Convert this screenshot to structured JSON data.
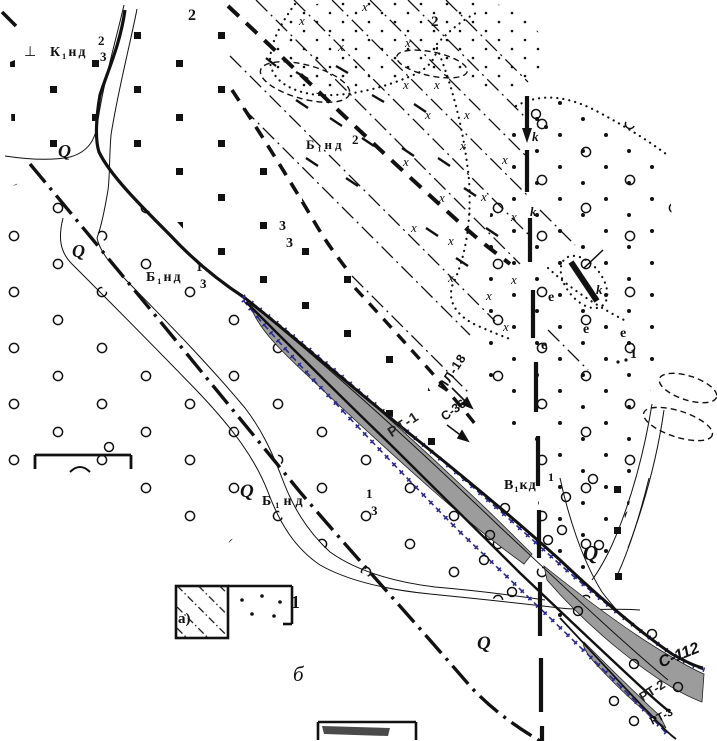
{
  "figure": {
    "type": "geological-sketch-map",
    "labels": {
      "q": "Q",
      "x": "x",
      "k": "k",
      "e": "e",
      "perp": "⊥",
      "unit_knd": "К₁нд",
      "unit_bnd": "Б₁нд",
      "unit_vkd": "В₁кд",
      "n1": "1",
      "n2": "2",
      "n3": "3",
      "ore_zone_1": "РТ-1",
      "ore_zone_2": "РТ-2",
      "ore_zone_3": "РТ-3",
      "borehole_c36": "С-36",
      "borehole_c112": "С-112",
      "profile_pl18": "ПЛ-18",
      "legend_a": "а)",
      "legend_b": "б",
      "legend_1": "1",
      "partial_1": "1"
    },
    "colors": {
      "ink": "#111111",
      "ore_fill": "#9c9c9c",
      "zone_outline_blue": "#2b2b8c",
      "background": "#ffffff"
    }
  }
}
